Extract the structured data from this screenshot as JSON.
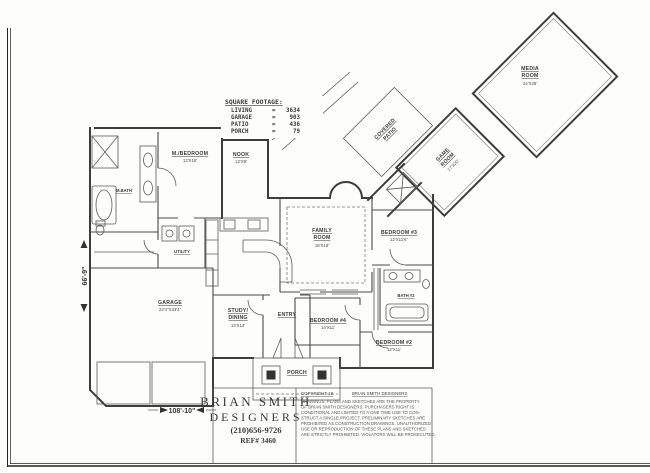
{
  "sheet": {
    "dim_width": "108'-10\"",
    "dim_height": "66'-9\""
  },
  "sqft": {
    "title": "SQUARE FOOTAGE:",
    "rows": [
      {
        "label": "LIVING",
        "eq": "=",
        "value": "3634"
      },
      {
        "label": "GARAGE",
        "eq": "=",
        "value": "903"
      },
      {
        "label": "PATIO",
        "eq": "=",
        "value": "436"
      },
      {
        "label": "PORCH",
        "eq": "=",
        "value": "79"
      }
    ]
  },
  "rooms": {
    "master": {
      "name": "M./BEDROOM",
      "dim": "13'X16'"
    },
    "nook": {
      "name": "NOOK",
      "dim": "12'X9'"
    },
    "family": {
      "name1": "FAMILY",
      "name2": "ROOM",
      "dim": "18'X18'"
    },
    "bedroom3": {
      "name": "BEDROOM  #3",
      "dim": "12'X11'6\""
    },
    "bedroom4": {
      "name": "BEDROOM  #4",
      "dim": "14'X11'"
    },
    "bedroom2": {
      "name": "BEDROOM  #2",
      "dim": "12'X11'"
    },
    "garage": {
      "name": "GARAGE",
      "dim": "23'4\"X33'4\""
    },
    "study": {
      "name1": "STUDY/",
      "name2": "DINING",
      "dim": "13'X13'"
    },
    "entry": {
      "name": "ENTRY"
    },
    "porch": {
      "name": "PORCH"
    },
    "mbath": {
      "name": "M.BATH"
    },
    "utility": {
      "name": "UTILITY"
    },
    "bath2": {
      "name": "BATH #2"
    },
    "media": {
      "name1": "MEDIA",
      "name2": "ROOM",
      "dim": "24'X28'"
    },
    "game": {
      "name1": "GAME",
      "name2": "ROOM",
      "dim": "17'X20'"
    },
    "covered_patio": {
      "name1": "COVERED",
      "name2": "PATIO"
    }
  },
  "title_block": {
    "name_line1": "BRIAN  SMITH",
    "name_line2": "DESIGNERS",
    "phone": "(210)656-9726",
    "ref": "REF#  3460"
  },
  "copyright": {
    "header_left": "COPYRIGHT 19",
    "header_right": "BRIAN  SMITH  DESIGNERS",
    "body_lines": [
      "DRAWINGS, PLANS AND SKETCHES ARE THE PROPERTY",
      "OF BRIAN SMITH DESIGNERS.  PURCHASERS RIGHT IS",
      "CONDITIONAL AND LIMITED TO A ONE TIME USE TO CON-",
      "STRUCT A SINGLE PROJECT.  PRELIMINARY SKETCHES ARE",
      "PROHIBITED AS CONSTRUCTION DRAWINGS.  UNAUTHORIZED",
      "USE OR REPRODUCTION OF THESE PLANS AND SKETCHES",
      "ARE STRICTLY PROHIBITED.  VIOLATORS WILL BE PROSECUTED."
    ]
  }
}
